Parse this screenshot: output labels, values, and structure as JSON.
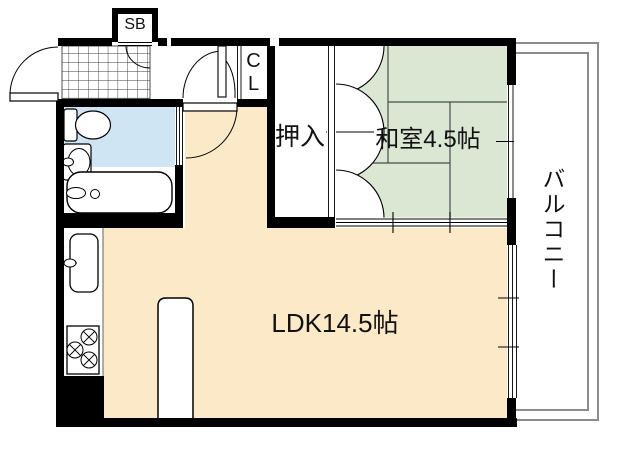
{
  "plan": {
    "type": "floorplan",
    "labels": {
      "shoe_box": "SB",
      "closet_line1": "C",
      "closet_line2": "L",
      "oshiire": "押入",
      "washitsu": "和室4.5帖",
      "ldk": "LDK14.5帖",
      "balcony": "バルコニー"
    },
    "colors": {
      "ldk_floor": "#fce9c8",
      "tatami": "#d9e7d3",
      "bathroom": "#cfe5f4",
      "wall": "#000000",
      "balcony_line": "#8c8c8c",
      "tatami_line": "#4c4c4c"
    }
  }
}
